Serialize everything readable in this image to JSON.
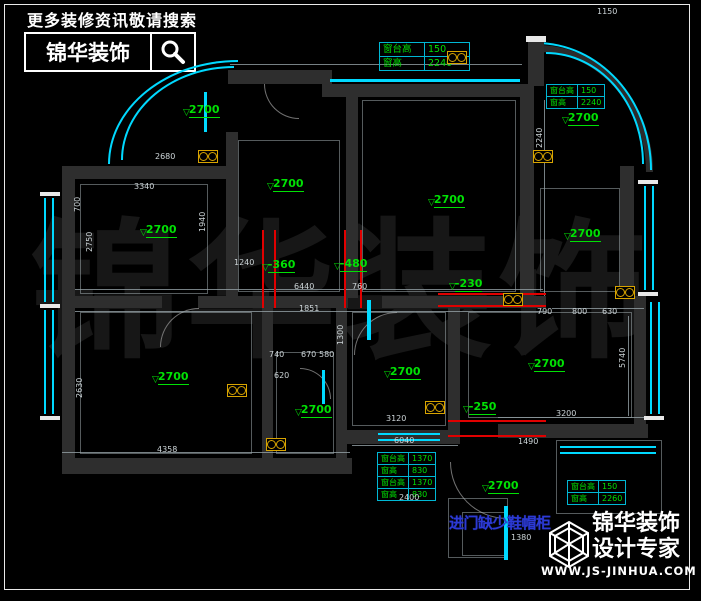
{
  "colors": {
    "background": "#000000",
    "wall": "#2e2e2e",
    "window_cyan": "#00d9ff",
    "label_green": "#00e104",
    "dimension_red": "#e10000",
    "symbol_yellow": "#d8a400",
    "note_blue": "#2c3ad4",
    "line_white": "#e9e9e9"
  },
  "promo": {
    "tagline": "更多装修资讯敬请搜索",
    "brand": "锦华装饰",
    "icon": "magnifier-icon"
  },
  "footer_logo": {
    "brand": "锦华装饰",
    "tagline": "设计专家",
    "website": "WWW.JS-JINHUA.COM",
    "icon": "cube-logo-icon"
  },
  "watermark": "锦华装饰",
  "annotation_note": "进门缺少鞋帽柜",
  "window_tables": [
    {
      "x": 379,
      "y": 42,
      "wide": true,
      "rows": [
        [
          "窗台高",
          "150"
        ],
        [
          "窗高",
          "2240"
        ]
      ]
    },
    {
      "x": 546,
      "y": 84,
      "wide": false,
      "rows": [
        [
          "窗台高",
          "150"
        ],
        [
          "窗高",
          "2240"
        ]
      ]
    },
    {
      "x": 377,
      "y": 452,
      "wide": false,
      "rows": [
        [
          "窗台高",
          "1370"
        ],
        [
          "窗高",
          "830"
        ],
        [
          "窗台高",
          "1370"
        ],
        [
          "窗高",
          "830"
        ]
      ]
    },
    {
      "x": 567,
      "y": 480,
      "wide": false,
      "rows": [
        [
          "窗台高",
          "150"
        ],
        [
          "窗高",
          "2260"
        ]
      ]
    }
  ],
  "level_markers": [
    {
      "value": "2700",
      "x": 183,
      "y": 104
    },
    {
      "value": "2700",
      "x": 267,
      "y": 178
    },
    {
      "value": "2700",
      "x": 140,
      "y": 224
    },
    {
      "value": "2700",
      "x": 428,
      "y": 194
    },
    {
      "value": "2700",
      "x": 562,
      "y": 112
    },
    {
      "value": "2700",
      "x": 564,
      "y": 228
    },
    {
      "value": "2700",
      "x": 152,
      "y": 371
    },
    {
      "value": "2700",
      "x": 295,
      "y": 404
    },
    {
      "value": "2700",
      "x": 384,
      "y": 366
    },
    {
      "value": "2700",
      "x": 528,
      "y": 358
    },
    {
      "value": "2700",
      "x": 482,
      "y": 480
    },
    {
      "value": "-360",
      "x": 262,
      "y": 259
    },
    {
      "value": "-480",
      "x": 334,
      "y": 258
    },
    {
      "value": "-230",
      "x": 449,
      "y": 278
    },
    {
      "value": "-250",
      "x": 463,
      "y": 401
    }
  ],
  "dimensions": [
    {
      "value": "2680",
      "x": 155,
      "y": 153
    },
    {
      "value": "3340",
      "x": 134,
      "y": 183
    },
    {
      "value": "1240",
      "x": 234,
      "y": 259
    },
    {
      "value": "1851",
      "x": 299,
      "y": 305
    },
    {
      "value": "6440",
      "x": 294,
      "y": 283
    },
    {
      "value": "760",
      "x": 352,
      "y": 283
    },
    {
      "value": "1150",
      "x": 597,
      "y": 8
    },
    {
      "value": "790",
      "x": 537,
      "y": 308
    },
    {
      "value": "800",
      "x": 572,
      "y": 308
    },
    {
      "value": "630",
      "x": 602,
      "y": 308
    },
    {
      "value": "3200",
      "x": 556,
      "y": 410
    },
    {
      "value": "1490",
      "x": 518,
      "y": 438
    },
    {
      "value": "2400",
      "x": 399,
      "y": 494
    },
    {
      "value": "1380",
      "x": 511,
      "y": 534
    },
    {
      "value": "3120",
      "x": 386,
      "y": 415
    },
    {
      "value": "6040",
      "x": 394,
      "y": 437
    },
    {
      "value": "740",
      "x": 269,
      "y": 351
    },
    {
      "value": "670",
      "x": 301,
      "y": 351
    },
    {
      "value": "580",
      "x": 319,
      "y": 351
    },
    {
      "value": "620",
      "x": 274,
      "y": 372
    },
    {
      "value": "4358",
      "x": 157,
      "y": 446
    },
    {
      "value": "700",
      "x": 74,
      "y": 212,
      "vertical": true
    },
    {
      "value": "2750",
      "x": 86,
      "y": 252,
      "vertical": true
    },
    {
      "value": "1940",
      "x": 199,
      "y": 232,
      "vertical": true
    },
    {
      "value": "2630",
      "x": 76,
      "y": 398,
      "vertical": true
    },
    {
      "value": "1300",
      "x": 337,
      "y": 345,
      "vertical": true
    },
    {
      "value": "5740",
      "x": 619,
      "y": 368,
      "vertical": true
    },
    {
      "value": "2240",
      "x": 536,
      "y": 148,
      "vertical": true
    }
  ],
  "electrical_symbols": [
    {
      "x": 198,
      "y": 150
    },
    {
      "x": 447,
      "y": 51
    },
    {
      "x": 533,
      "y": 150
    },
    {
      "x": 615,
      "y": 286
    },
    {
      "x": 425,
      "y": 401
    },
    {
      "x": 503,
      "y": 293
    },
    {
      "x": 266,
      "y": 438
    },
    {
      "x": 227,
      "y": 384
    }
  ]
}
